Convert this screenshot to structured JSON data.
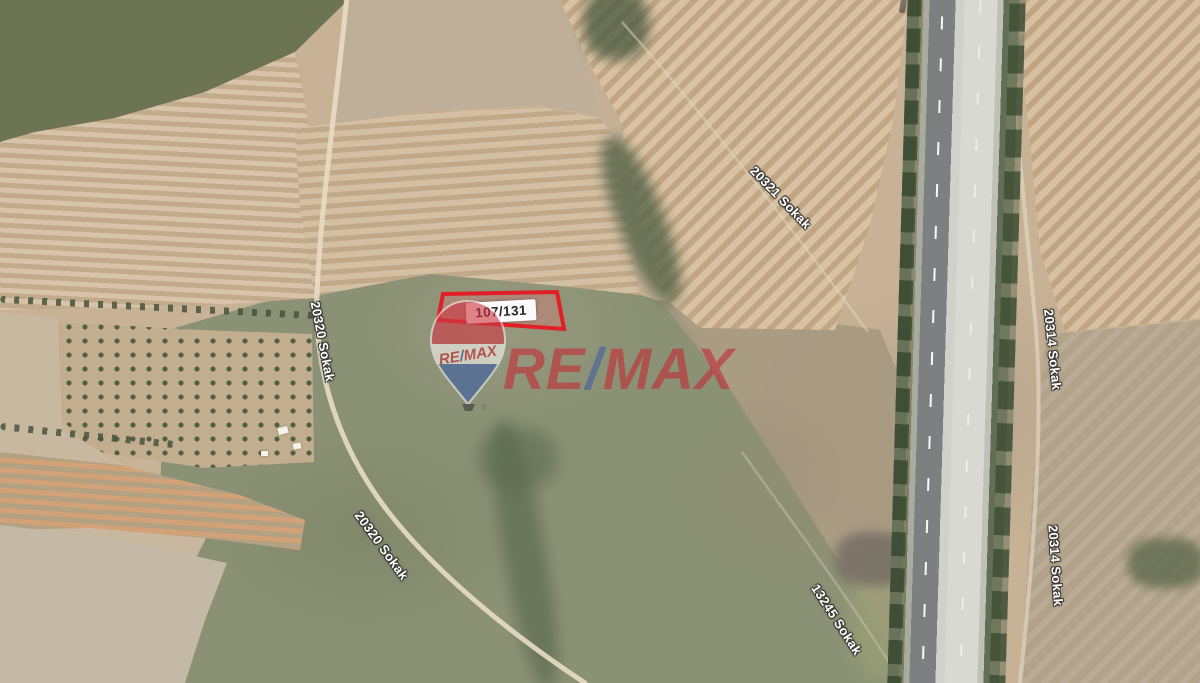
{
  "parcel": {
    "label": "107/131",
    "border_color": "#e01f26"
  },
  "balloon_logo": {
    "re": "RE",
    "slash": "/",
    "max": "MAX",
    "registered": "®",
    "red": "#c62a34",
    "blue": "#2b4f9e"
  },
  "watermark": {
    "re": "RE",
    "slash": "/",
    "max": "MAX",
    "red": "#c52934",
    "blue": "#44619f"
  },
  "street_labels": [
    {
      "text": "20321 Sokak"
    },
    {
      "text": "20320 Sokak"
    },
    {
      "text": "20320 Sokak"
    },
    {
      "text": "20314 Sokak"
    },
    {
      "text": "20314 Sokak"
    },
    {
      "text": "13245 Sokak"
    }
  ]
}
